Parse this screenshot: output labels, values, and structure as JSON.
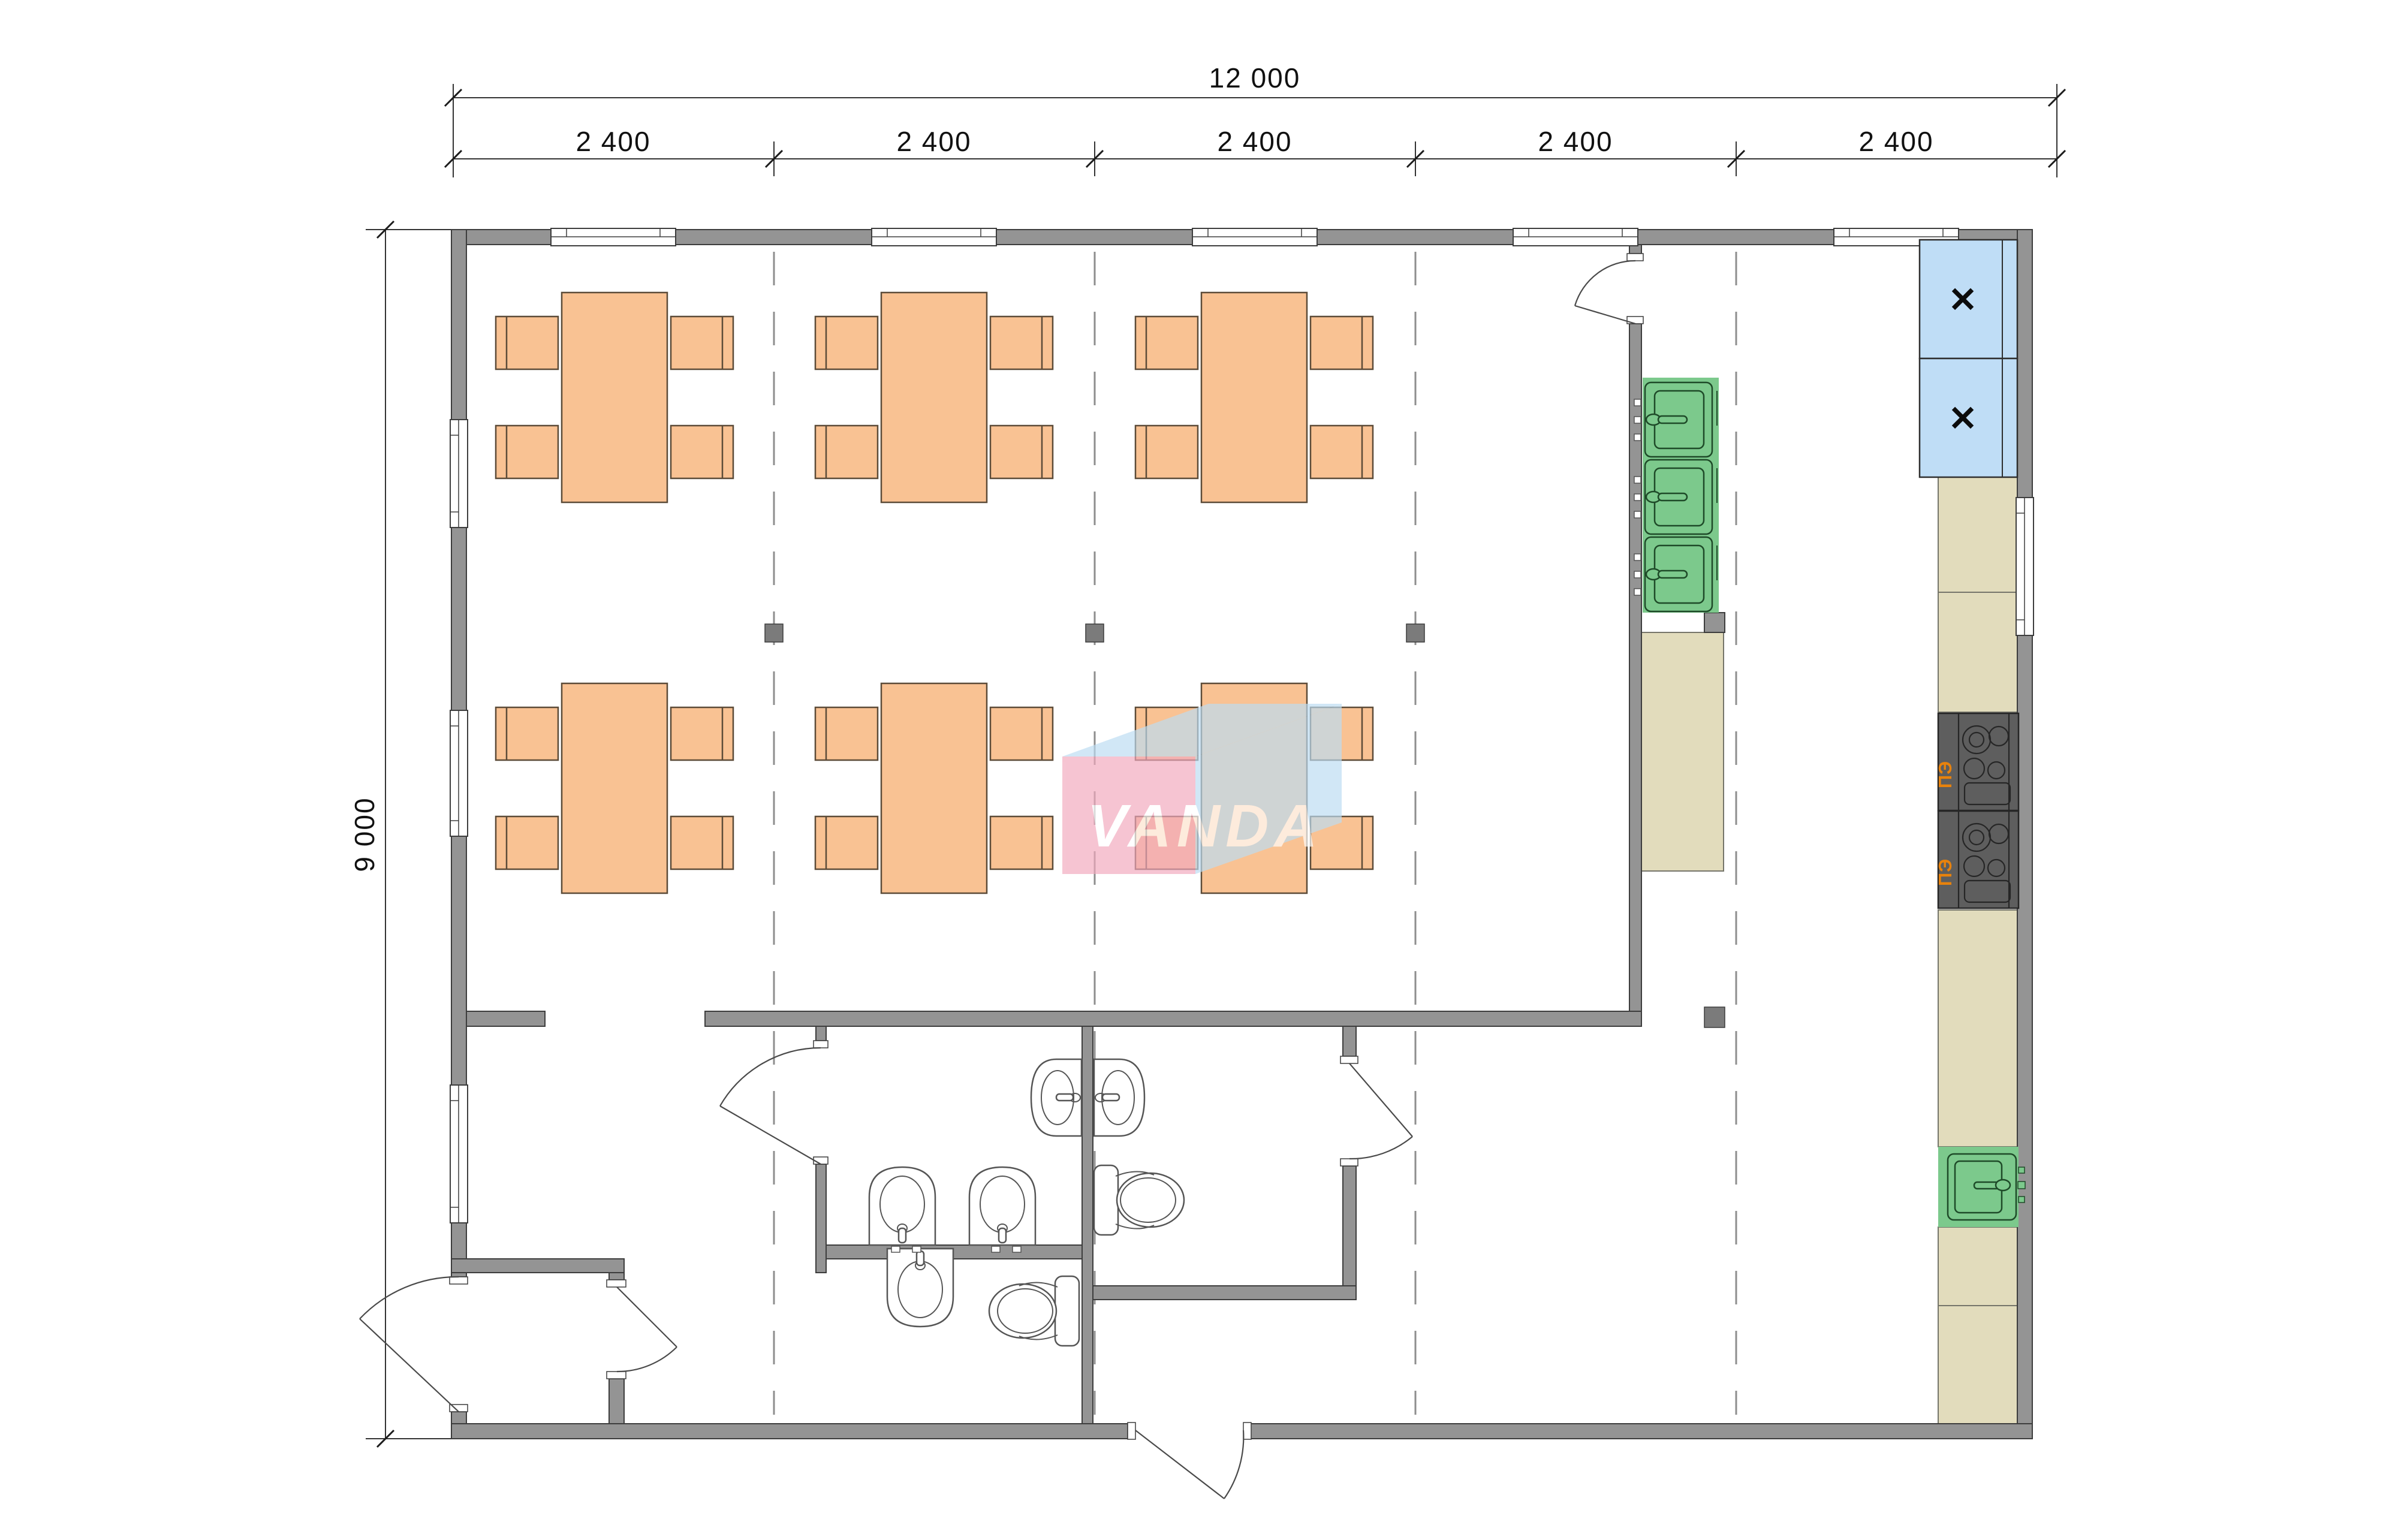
{
  "dimensions": {
    "overall_width": "12 000",
    "bays": [
      "2 400",
      "2 400",
      "2 400",
      "2 400",
      "2 400"
    ],
    "overall_height": "9 000"
  },
  "watermark": {
    "text": "VANDA"
  },
  "appliances": {
    "fridge_mark": "✕",
    "stove_label": "ПЭ"
  },
  "colors": {
    "wall": "#949494",
    "wall_line": "#3d3d3d",
    "dim": "#333333",
    "text": "#111111",
    "grid": "#8e8e8e",
    "table": "#F9C293",
    "table_line": "#5c4b38",
    "fridge": "#BFDDF6",
    "sink": "#7CC98C",
    "counter": "#E2DCBC",
    "stove": "#5E5E5E",
    "stove_label": "#E8820C",
    "fixture_line": "#555555",
    "logo_pink": "#F2A9BE",
    "logo_blue": "#BCDDF3",
    "logo_text": "#FFFFFF"
  }
}
